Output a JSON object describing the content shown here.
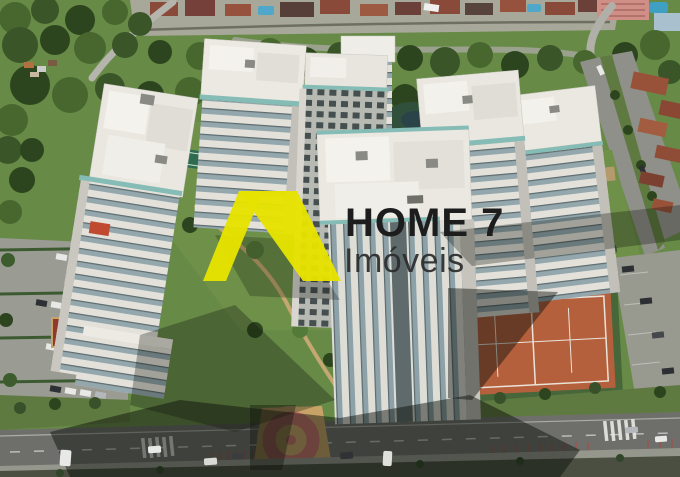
{
  "watermark": {
    "brand": "HOME 7",
    "subtitle": "Imóveis",
    "mark_color": "#e7e300",
    "brand_text_color": "#1d1d1d",
    "subtitle_text_color": "#2c2c2c"
  },
  "scene": {
    "type": "aerial-drone-photo",
    "description": "Aerial view of a residential condominium complex: white high-rise towers around central gardens with a pool, clay tennis courts, parking lots, a tree-lined avenue with terracotta-roofed houses, dense forest at the top and a street with crosswalks and a circular mosaic plaza at the bottom",
    "palette": {
      "forest": "#3a5628",
      "lawn": "#678a47",
      "tower_wall": "#e9e7e0",
      "window_band": "#93a7ad",
      "glass_balcony": "#86bcb6",
      "road": "#8f9089",
      "tennis_clay": "#b5603c",
      "plaza_ring": "#c4706a",
      "plaza_base": "#c8a368",
      "house_roof": "#99523a",
      "pool": "#3f9aa8",
      "shadow": "rgba(12,16,10,0.5)"
    }
  }
}
